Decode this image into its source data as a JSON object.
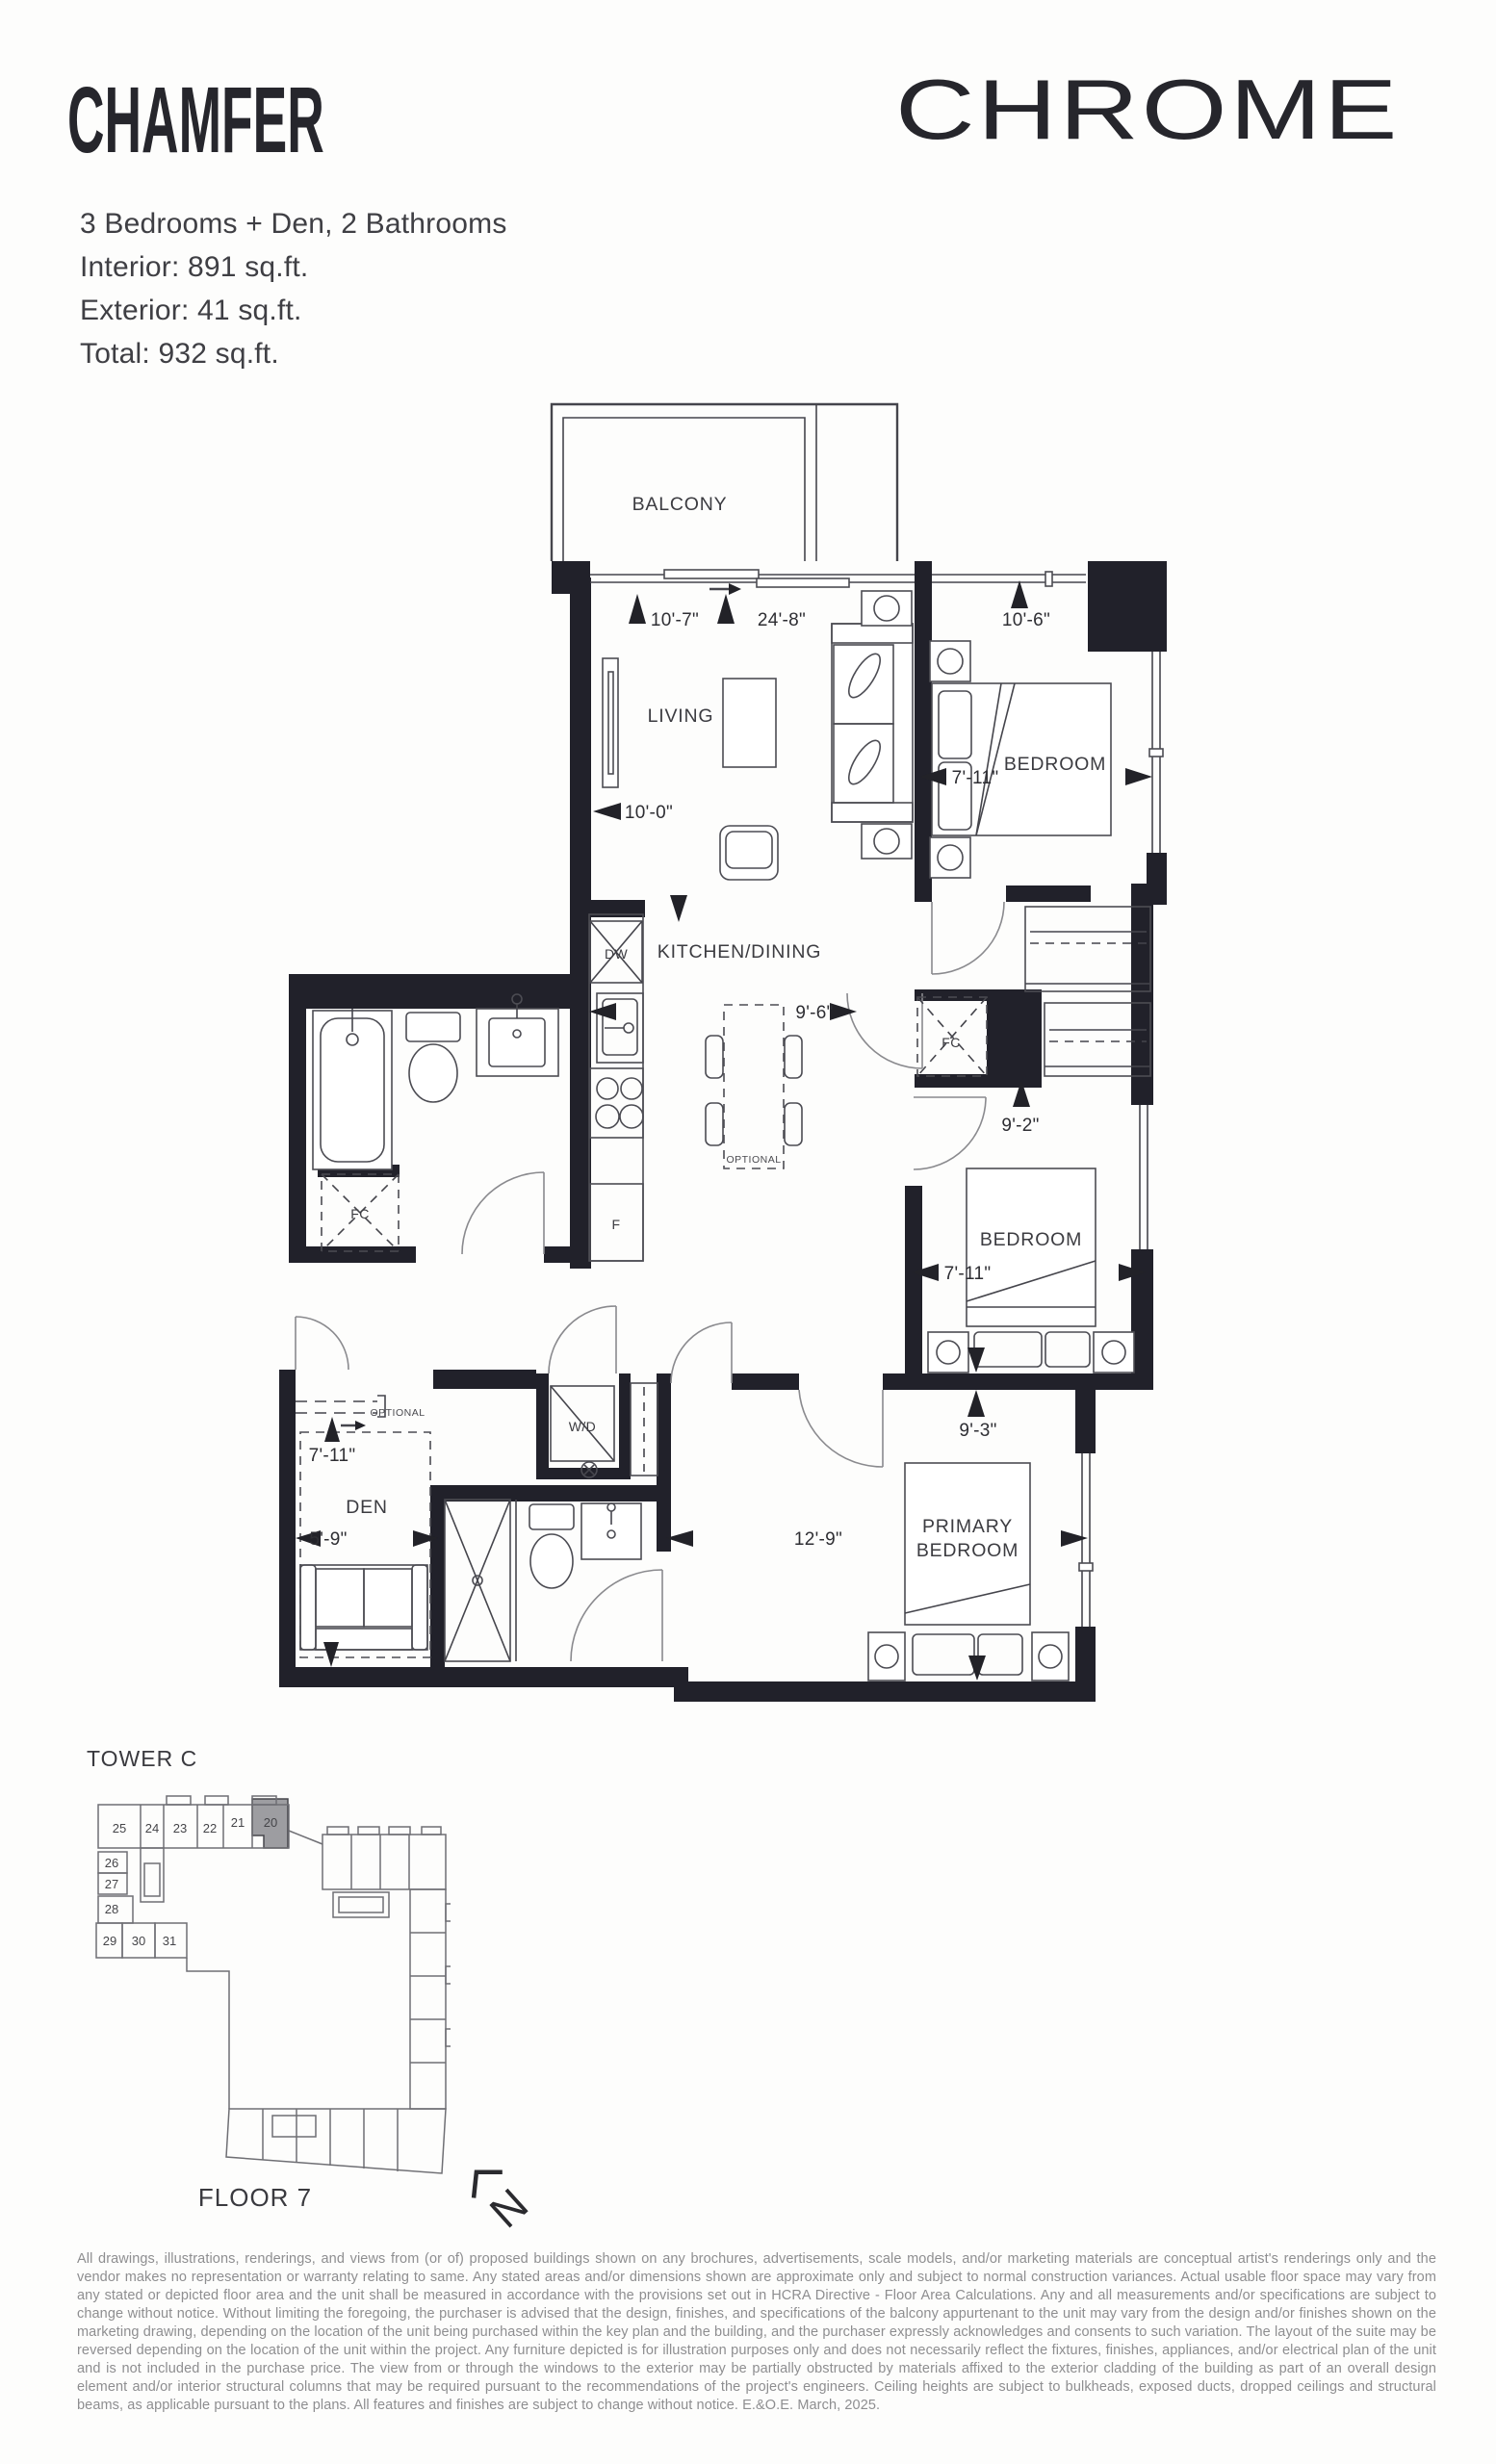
{
  "header": {
    "title": "CHAMFER",
    "brand": "CHROME",
    "specs": [
      "3 Bedrooms + Den, 2 Bathrooms",
      "Interior: 891 sq.ft.",
      "Exterior: 41 sq.ft.",
      "Total: 932 sq.ft."
    ]
  },
  "plan": {
    "rooms": {
      "balcony": "BALCONY",
      "living": "LIVING",
      "kitchen": "KITCHEN/DINING",
      "bedroom1": "BEDROOM",
      "bedroom2": "BEDROOM",
      "primary_line1": "PRIMARY",
      "primary_line2": "BEDROOM",
      "den": "DEN"
    },
    "labels": {
      "dw": "DW",
      "fridge": "F",
      "wd": "W/D",
      "fc_bath": "FC",
      "fc_hall": "FC",
      "optional_dining": "OPTIONAL",
      "optional_den": "OPTIONAL"
    },
    "dims": {
      "living_top": "10'-7\"",
      "suite_length": "24'-8\"",
      "bedroom1_top": "10'-6\"",
      "bedroom1_side": "7'-11\"",
      "living_left": "10'-0\"",
      "kitchen": "9'-6\"",
      "closet": "9'-2\"",
      "bedroom2_side": "7'-11\"",
      "bedroom2_bottom": "9'-3\"",
      "den_top": "7'-11\"",
      "den": "5'-9\"",
      "primary": "12'-9\""
    }
  },
  "keyplan": {
    "tower": "TOWER C",
    "floor": "FLOOR 7",
    "units_top": [
      "25",
      "24",
      "23",
      "22",
      "21",
      "20"
    ],
    "units_side": [
      "26",
      "27",
      "28"
    ],
    "units_bottom": [
      "29",
      "30",
      "31"
    ],
    "highlighted_unit": "20",
    "highlight_color": "#9d9da1",
    "north": "N"
  },
  "disclaimer": "All drawings, illustrations, renderings, and views from (or of) proposed buildings shown on any brochures, advertisements, scale models, and/or marketing materials are conceptual artist's renderings only and the vendor makes no representation or warranty relating to same. Any stated areas and/or dimensions shown are approximate only and subject to normal construction variances. Actual usable floor space may vary from any stated or depicted floor area and the unit shall be measured in accordance with the provisions set out in HCRA Directive - Floor Area Calculations. Any and all measurements and/or specifications are subject to change without notice. Without limiting the foregoing, the purchaser is advised that the design, finishes, and specifications of the balcony appurtenant to the unit may vary from the design and/or finishes shown on the marketing drawing, depending on the location of the unit being purchased within the key plan and the building, and the purchaser expressly acknowledges and consents to such variation. The layout of the suite may be reversed depending on the location of the unit within the project. Any furniture depicted is for illustration purposes only and does not necessarily reflect the fixtures, finishes, appliances, and/or electrical plan of the unit and is not included in the purchase price. The view from or through the windows to the exterior may be partially obstructed by materials affixed to the exterior cladding of the building as part of an overall design element and/or interior structural columns that may be required pursuant to the recommendations of the project's engineers. Ceiling heights are subject to bulkheads, exposed ducts, dropped ceilings and structural beams, as applicable pursuant to the plans. All features and finishes are subject to change without notice. E.&O.E. March, 2025."
}
